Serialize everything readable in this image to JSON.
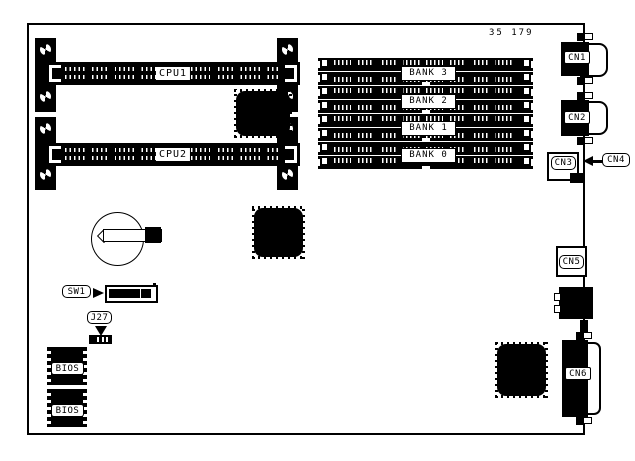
{
  "diagram": {
    "part_number": "35 179",
    "cpu_slots": [
      "CPU1",
      "CPU2"
    ],
    "memory_banks": [
      "BANK 3",
      "BANK 2",
      "BANK 1",
      "BANK 0"
    ],
    "connectors": [
      "CN1",
      "CN2",
      "CN3",
      "CN4",
      "CN5",
      "CN6"
    ],
    "switch_label": "SW1",
    "jumper_label": "J27",
    "bios_labels": [
      "BIOS",
      "BIOS"
    ],
    "colors": {
      "ink": "#000000",
      "paper": "#ffffff"
    }
  }
}
